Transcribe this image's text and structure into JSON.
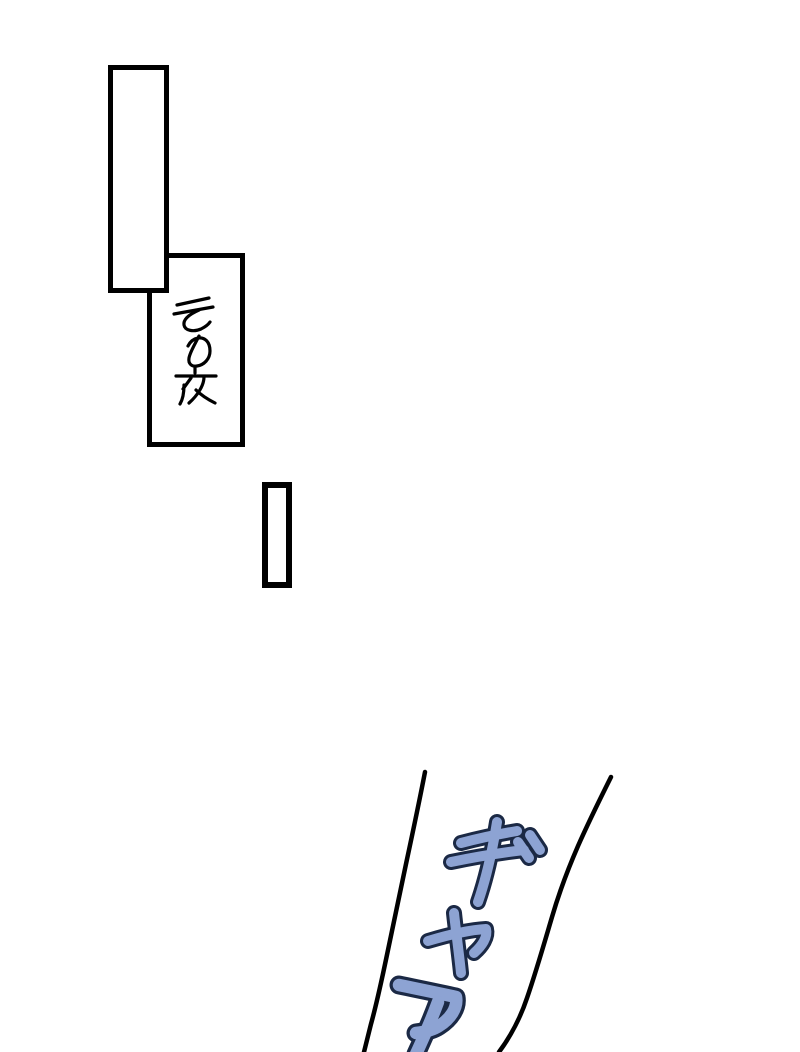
{
  "colors": {
    "paper": "#ffffff",
    "ink": "#000000",
    "scream_fill": "#8da3d3",
    "scream_outline": "#1b2945"
  },
  "caption": {
    "text": "その夜"
  },
  "scream": {
    "text": "ギャア"
  }
}
